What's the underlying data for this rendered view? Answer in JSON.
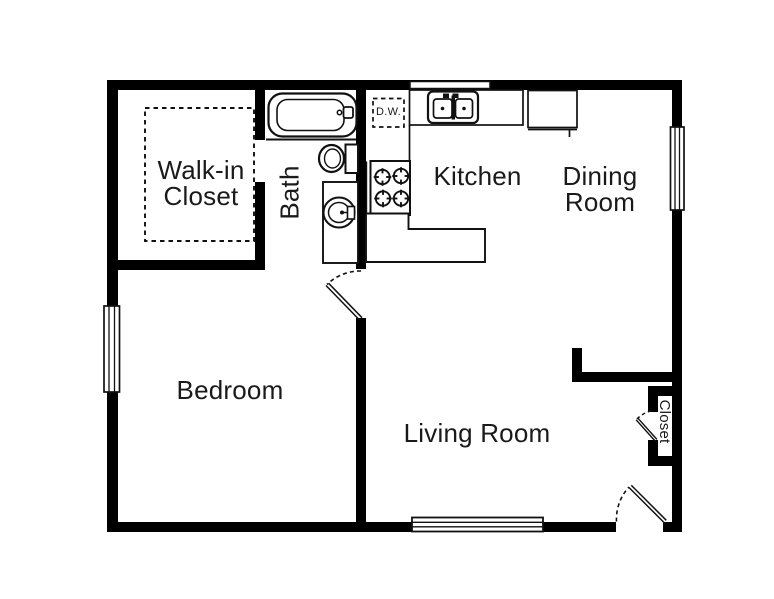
{
  "plan": {
    "type": "apartment-floor-plan",
    "colors": {
      "wall": "#000000",
      "line": "#111111",
      "text": "#1a1a1a",
      "background": "#ffffff"
    }
  },
  "rooms": {
    "walk_in_closet": {
      "line1": "Walk-in",
      "line2": "Closet"
    },
    "bath": {
      "label": "Bath"
    },
    "kitchen": {
      "label": "Kitchen"
    },
    "dining_room": {
      "line1": "Dining",
      "line2": "Room"
    },
    "bedroom": {
      "label": "Bedroom"
    },
    "living_room": {
      "label": "Living Room"
    },
    "closet": {
      "label": "Closet"
    }
  },
  "fixtures": {
    "dishwasher": {
      "label": "D.W."
    }
  }
}
